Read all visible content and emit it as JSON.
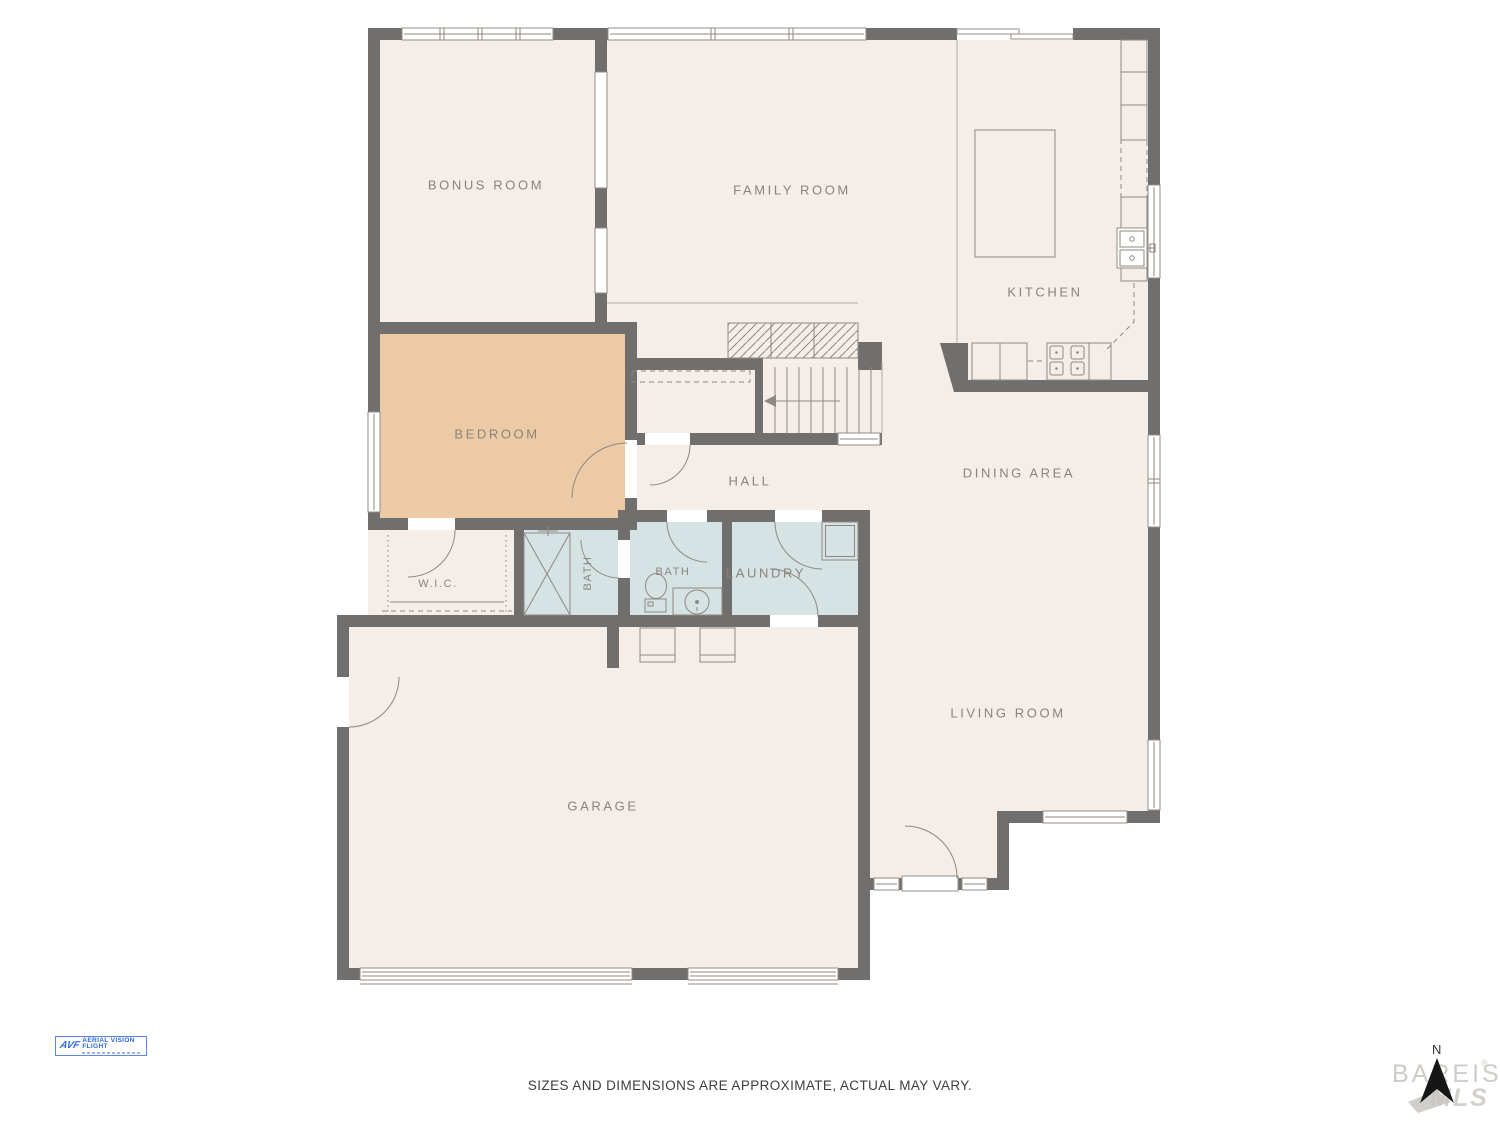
{
  "colors": {
    "wall": "#706f6d",
    "floor": "#f5ede8",
    "bedroom": "#eccaa6",
    "wet_rooms": "#d5e3e4",
    "fixture_line": "#8f8880",
    "label": "#8a837c",
    "logo_blue": "#2f6bdb"
  },
  "rooms": [
    {
      "id": "bonus-room",
      "label": "BONUS ROOM",
      "x": 486,
      "y": 185
    },
    {
      "id": "family-room",
      "label": "FAMILY ROOM",
      "x": 792,
      "y": 190
    },
    {
      "id": "kitchen",
      "label": "KITCHEN",
      "x": 1045,
      "y": 292
    },
    {
      "id": "bedroom",
      "label": "BEDROOM",
      "x": 497,
      "y": 434
    },
    {
      "id": "hall",
      "label": "HALL",
      "x": 750,
      "y": 481
    },
    {
      "id": "dining-area",
      "label": "DINING AREA",
      "x": 1019,
      "y": 473
    },
    {
      "id": "wic",
      "label": "W.I.C.",
      "x": 438,
      "y": 584,
      "small": true
    },
    {
      "id": "bath-1",
      "label": "BATH",
      "x": 588,
      "y": 573,
      "small": true,
      "vertical": true
    },
    {
      "id": "bath-2",
      "label": "BATH",
      "x": 673,
      "y": 572,
      "small": true
    },
    {
      "id": "laundry",
      "label": "LAUNDRY",
      "x": 766,
      "y": 573
    },
    {
      "id": "garage",
      "label": "GARAGE",
      "x": 603,
      "y": 806
    },
    {
      "id": "living-room",
      "label": "LIVING ROOM",
      "x": 1008,
      "y": 713
    }
  ],
  "footer": {
    "disclaimer": "SIZES AND DIMENSIONS ARE APPROXIMATE, ACTUAL MAY VARY."
  },
  "compass": {
    "label": "N",
    "watermark_top": "BAREIS",
    "watermark_reg": "®",
    "watermark_bottom": "MLS"
  },
  "logo": {
    "mark": "AVF",
    "brand": "AERIAL VISION FLIGHT"
  }
}
